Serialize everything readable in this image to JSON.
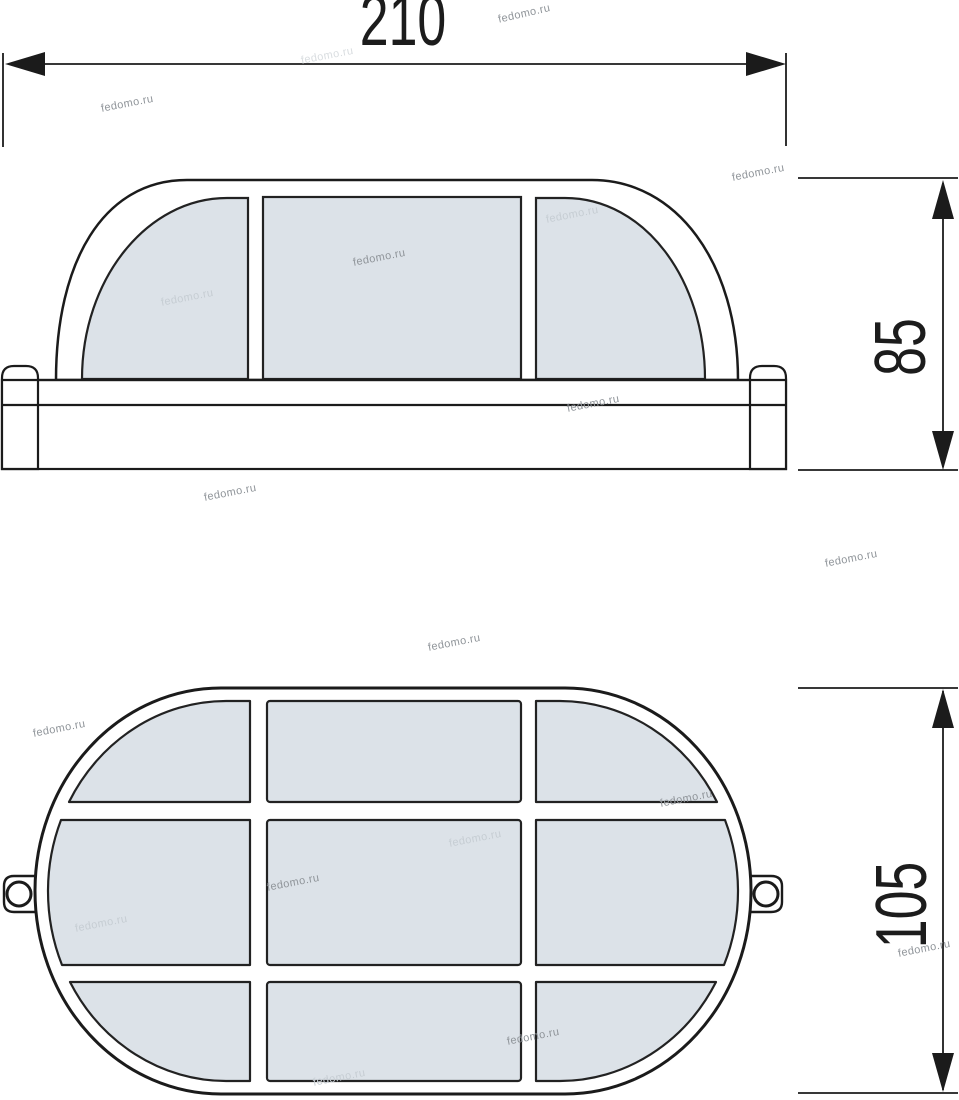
{
  "document": {
    "kind": "technical-dimension-drawing",
    "subject": "oval bulkhead lamp, two orthographic views"
  },
  "watermark": {
    "text": "fedomo.ru"
  },
  "dimensions": {
    "width": {
      "value": "210"
    },
    "side_height": {
      "value": "85"
    },
    "front_height": {
      "value": "105"
    }
  },
  "views": {
    "side_view": {
      "glass_panel_count": 3
    },
    "front_view": {
      "glass_panel_rows": 3,
      "glass_panel_cols": 3,
      "mounting_ears": 2
    }
  },
  "colors": {
    "background": "#ffffff",
    "line": "#1b1b1b",
    "glass_fill": "#dce2e8",
    "watermark": "#8f9499",
    "watermark_light": "#c6cdd3"
  }
}
